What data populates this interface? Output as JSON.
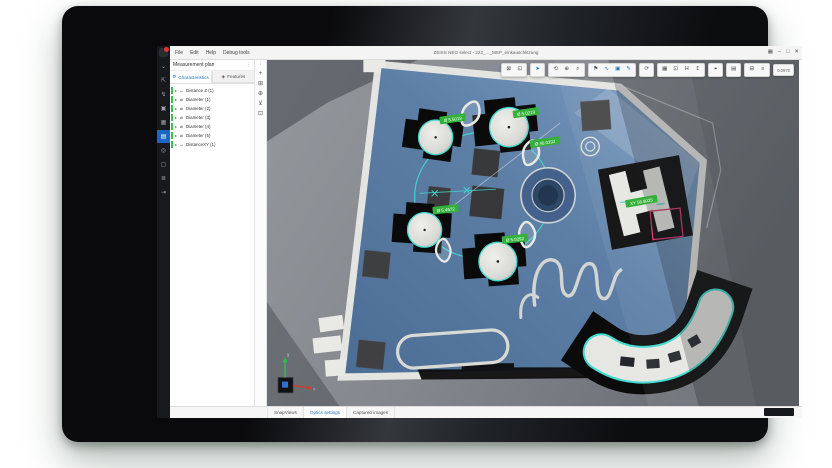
{
  "app": {
    "title": "ZEISS NEO select - 222_..._MSP_einkauschlitzung",
    "menu": [
      "File",
      "Edit",
      "Help",
      "Debug tools"
    ],
    "window_controls": [
      {
        "name": "layout-icon",
        "glyph": "▦"
      },
      {
        "name": "minimize-icon",
        "glyph": "–"
      },
      {
        "name": "maximize-icon",
        "glyph": "□"
      },
      {
        "name": "close-icon",
        "glyph": "✕"
      }
    ]
  },
  "sidebar": {
    "items": [
      {
        "name": "collapse",
        "glyph": "⌄",
        "active": false
      },
      {
        "name": "export-window",
        "glyph": "⇱",
        "active": false
      },
      {
        "name": "probe",
        "glyph": "↯",
        "active": false
      },
      {
        "name": "image",
        "glyph": "▣",
        "active": false
      },
      {
        "name": "gallery",
        "glyph": "▦",
        "active": false
      },
      {
        "name": "measurement-plan",
        "glyph": "▤",
        "active": true
      },
      {
        "name": "target",
        "glyph": "◎",
        "active": false
      },
      {
        "name": "snapshot",
        "glyph": "▢",
        "active": false
      },
      {
        "name": "report",
        "glyph": "≣",
        "active": false
      },
      {
        "name": "exit",
        "glyph": "⇥",
        "active": false
      }
    ]
  },
  "panel": {
    "title": "Measurement plan",
    "menu_glyph": "⋮",
    "expand_glyph": "▸",
    "tabs": [
      {
        "label": "Characteristics",
        "glyph": "⚙"
      },
      {
        "label": "Features",
        "glyph": "◈"
      }
    ],
    "tree": [
      {
        "glyph": "↔",
        "label": "Distance Z (1)"
      },
      {
        "glyph": "⌀",
        "label": "Diameter (1)"
      },
      {
        "glyph": "⌀",
        "label": "Diameter (2)"
      },
      {
        "glyph": "⌀",
        "label": "Diameter (3)"
      },
      {
        "glyph": "⌀",
        "label": "Diameter (4)"
      },
      {
        "glyph": "⌀",
        "label": "Diameter (5)"
      },
      {
        "glyph": "↔",
        "label": "DistanceXY (1)"
      }
    ]
  },
  "viewport_tools": [
    {
      "name": "more",
      "glyph": "⋮"
    },
    {
      "name": "add-feature",
      "glyph": "+"
    },
    {
      "name": "copy-view",
      "glyph": "⊞"
    },
    {
      "name": "move-stage",
      "glyph": "⊕"
    },
    {
      "name": "alignment",
      "glyph": "⊻"
    },
    {
      "name": "display-mode",
      "glyph": "⊡"
    }
  ],
  "toolbar": {
    "groups": [
      {
        "buttons": [
          {
            "name": "fit-view",
            "glyph": "⊠"
          },
          {
            "name": "fit-screen",
            "glyph": "⊡"
          }
        ]
      },
      {
        "buttons": [
          {
            "name": "select-cursor",
            "glyph": "➤"
          }
        ]
      },
      {
        "buttons": [
          {
            "name": "rotate-view",
            "glyph": "⟲"
          },
          {
            "name": "pan-view",
            "glyph": "⊕"
          },
          {
            "name": "zoom-view",
            "glyph": "⌕"
          }
        ]
      },
      {
        "buttons": [
          {
            "name": "flag-tool",
            "glyph": "⚑"
          },
          {
            "name": "polyline-tool",
            "glyph": "∿"
          },
          {
            "name": "rect-tool",
            "glyph": "▣"
          },
          {
            "name": "pen-tool",
            "glyph": "✎"
          }
        ]
      },
      {
        "buttons": [
          {
            "name": "refresh-view",
            "glyph": "⟳"
          }
        ]
      },
      {
        "buttons": [
          {
            "name": "snapshot-image",
            "glyph": "▦"
          },
          {
            "name": "crop-image",
            "glyph": "⊡"
          },
          {
            "name": "histogram",
            "glyph": "H"
          },
          {
            "name": "export-image",
            "glyph": "↥"
          }
        ]
      },
      {
        "buttons": [
          {
            "name": "search-zoom",
            "glyph": "⌖"
          }
        ]
      },
      {
        "buttons": [
          {
            "name": "layers",
            "glyph": "▤"
          }
        ]
      },
      {
        "buttons": [
          {
            "name": "display-settings",
            "glyph": "⊟"
          },
          {
            "name": "document-view",
            "glyph": "≡"
          }
        ]
      }
    ],
    "readout": "0.0970"
  },
  "scene": {
    "labels": [
      {
        "text": "Ø 5.5019"
      },
      {
        "text": "Ø 5.0219"
      },
      {
        "text": "Ø 40.0292"
      },
      {
        "text": "Ø 5.4672"
      },
      {
        "text": "Ø 5.0292"
      },
      {
        "text": "XY 56.8025"
      }
    ],
    "axis": {
      "x": "x",
      "y": "y"
    }
  },
  "statusbar": {
    "tabs": [
      {
        "label": "SnapViews",
        "active": false
      },
      {
        "label": "Optics settings",
        "active": true
      },
      {
        "label": "Captured images",
        "active": false
      }
    ]
  },
  "colors": {
    "accent": "#1d6fc2",
    "label_green": "#33b13a",
    "outline_cyan": "#3fd9ce",
    "selection_pink": "#d6336c",
    "tree_green": "#35c24d"
  }
}
